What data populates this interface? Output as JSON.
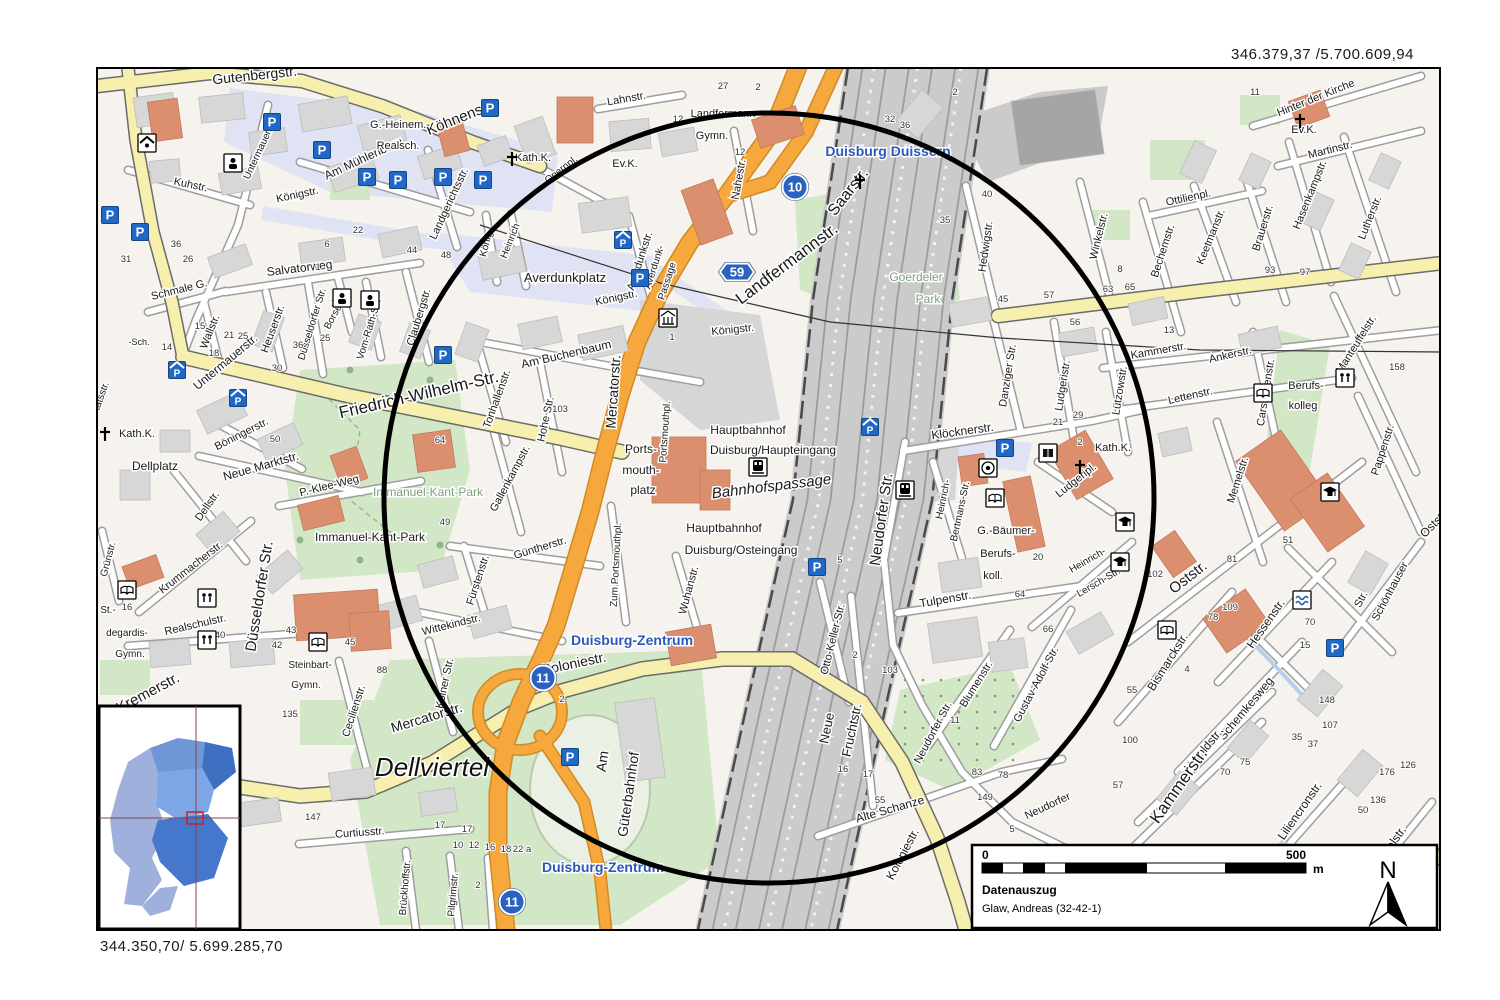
{
  "page": {
    "coordinates_top_right": "346.379,37 /5.700.609,94",
    "coordinates_bottom_left": "344.350,70/ 5.699.285,70"
  },
  "legend": {
    "scale_start": "0",
    "scale_end": "500",
    "scale_unit": "m",
    "title": "Datenauszug",
    "author": "Glaw, Andreas (32-42-1)",
    "north_label": "N"
  },
  "colors": {
    "street_fill": "#ffffff",
    "street_casing": "#9e9e9e",
    "main_road_yellow": "#f6efad",
    "motorway_orange": "#f6a83d",
    "park_green": "#d2e7c6",
    "pedestrian_blue": "#dfe3f4",
    "railway_gray": "#cbcbcb",
    "building_gray": "#d7d7d7",
    "building_salmon": "#db8f6f",
    "badge_blue": "#2a62c0",
    "place_label_blue": "#2c59b8",
    "park_label_green": "#7da07d",
    "circle_black": "#000000",
    "inset_blues": [
      "#9fb0dc",
      "#6f97d8",
      "#3f6fc0",
      "#7da6e6",
      "#4577cc"
    ]
  },
  "badges": [
    {
      "shape": "circle",
      "label": "10",
      "x": 795,
      "y": 187
    },
    {
      "shape": "circle",
      "label": "11",
      "x": 543,
      "y": 678
    },
    {
      "shape": "circle",
      "label": "11",
      "x": 512,
      "y": 902
    },
    {
      "shape": "motorway",
      "label": "59",
      "x": 737,
      "y": 272
    }
  ],
  "labels": [
    [
      "Gutenbergstr.",
      255,
      80,
      -6,
      14
    ],
    [
      "Köhnenstr.",
      462,
      122,
      -22,
      15
    ],
    [
      "Am Mühlenberg",
      365,
      162,
      -25,
      12
    ],
    [
      "G.-Heinem.-",
      400,
      128,
      0,
      11,
      "p"
    ],
    [
      "Realsch.",
      398,
      149,
      0,
      11,
      "p"
    ],
    [
      "Kath.K.",
      533,
      161,
      0,
      11,
      "p"
    ],
    [
      "Opernpl.",
      563,
      172,
      -38,
      10
    ],
    [
      "Kuhstr.",
      190,
      188,
      12,
      11
    ],
    [
      "Untermauerstr.",
      263,
      150,
      -65,
      10
    ],
    [
      "Untermauerstr.",
      228,
      365,
      -40,
      12
    ],
    [
      "Königstr.",
      298,
      198,
      -12,
      11
    ],
    [
      "Königstr.",
      617,
      301,
      -12,
      11
    ],
    [
      "Königstr.",
      733,
      333,
      -6,
      11
    ],
    [
      "Salvatorweg",
      300,
      272,
      -7,
      12
    ],
    [
      "Schmale G.",
      180,
      293,
      -14,
      11
    ],
    [
      "Wallstr.",
      213,
      333,
      -68,
      11
    ],
    [
      "Heuserstr.",
      276,
      330,
      -70,
      11
    ],
    [
      "Düsseldorfer Str.",
      315,
      325,
      -73,
      10
    ],
    [
      "Borsenstr.",
      340,
      310,
      -62,
      10
    ],
    [
      "Vom-Rath-Str.",
      372,
      330,
      -73,
      10
    ],
    [
      "Claubergstr.",
      422,
      318,
      -73,
      11
    ],
    [
      "Landgerichtsstr.",
      452,
      205,
      -65,
      11
    ],
    [
      "König",
      489,
      245,
      -75,
      10
    ],
    [
      "Heinrich",
      513,
      242,
      -68,
      10
    ],
    [
      "Averdunkplatz",
      565,
      282,
      0,
      13,
      "p"
    ],
    [
      "Am Buchenbaum",
      567,
      358,
      -13,
      12
    ],
    [
      "Tonhallenstr.",
      500,
      400,
      -70,
      11
    ],
    [
      "Hohe Str.",
      549,
      420,
      -78,
      11
    ],
    [
      "Friedrich-Wilhelm-Str.",
      420,
      400,
      -13,
      17
    ],
    [
      "Böningerstr.",
      243,
      437,
      -27,
      11
    ],
    [
      "Kath.K.",
      137,
      437,
      0,
      11,
      "p"
    ],
    [
      "Dellplatz",
      155,
      470,
      0,
      12,
      "p"
    ],
    [
      "Neue Marktstr.",
      262,
      470,
      -16,
      12
    ],
    [
      "P.-Klee-Weg",
      330,
      489,
      -14,
      11
    ],
    [
      "Immanuel-Kant-Park",
      428,
      496,
      0,
      12,
      "g"
    ],
    [
      "Immanuel-Kant-Park",
      370,
      541,
      0,
      12,
      "p"
    ],
    [
      "Dellstr.",
      210,
      508,
      -55,
      11
    ],
    [
      "Gallenkampstr.",
      513,
      480,
      -62,
      11
    ],
    [
      "Güntherstr.",
      541,
      551,
      -17,
      11
    ],
    [
      "Fürstenstr.",
      481,
      581,
      -72,
      11
    ],
    [
      "Wittekindstr.",
      452,
      628,
      -14,
      11
    ],
    [
      "Kölner Str.",
      448,
      684,
      -78,
      11
    ],
    [
      "Mercatorstr.",
      428,
      722,
      -17,
      14
    ],
    [
      "Mercatorstr.",
      618,
      392,
      -86,
      14
    ],
    [
      "Koloniestr.",
      575,
      668,
      -12,
      14
    ],
    [
      "Duisburg-Zentrum",
      632,
      645,
      0,
      14,
      "b"
    ],
    [
      "Duisburg-Zentrum",
      603,
      872,
      0,
      14,
      "b"
    ],
    [
      "Steinbart-",
      310,
      668,
      0,
      10,
      "p"
    ],
    [
      "Gymn.",
      306,
      688,
      0,
      10,
      "p"
    ],
    [
      "Cecilienstr.",
      357,
      712,
      -72,
      11
    ],
    [
      "Dellviertel",
      432,
      776,
      0,
      26,
      "i"
    ],
    [
      "Am",
      607,
      762,
      -82,
      14
    ],
    [
      "Güterbahnhof",
      633,
      795,
      -82,
      14
    ],
    [
      "Curtiusstr.",
      360,
      836,
      -4,
      11
    ],
    [
      "Krummacherstr.",
      193,
      570,
      -38,
      11
    ],
    [
      "Realschulstr.",
      196,
      628,
      -13,
      11
    ],
    [
      "Düsseldorfer Str.",
      264,
      597,
      -81,
      15
    ],
    [
      "St.-",
      108,
      613,
      0,
      10,
      "p"
    ],
    [
      "degardis-",
      127,
      636,
      0,
      10,
      "p"
    ],
    [
      "Gymn.",
      130,
      657,
      0,
      10,
      "p"
    ],
    [
      "Grünstr.",
      111,
      560,
      -75,
      10
    ],
    [
      "Kremerstr.",
      150,
      697,
      -28,
      15
    ],
    [
      "Brückhoffstr.",
      408,
      888,
      -85,
      10
    ],
    [
      "Pilgrimstr.",
      456,
      895,
      -85,
      10
    ],
    [
      "tätsstr.",
      104,
      397,
      -70,
      10
    ],
    [
      "-Sch.",
      139,
      345,
      0,
      9,
      "p"
    ],
    [
      "Lahnstr.",
      627,
      102,
      -10,
      11
    ],
    [
      "Landfermann",
      723,
      117,
      0,
      11,
      "p"
    ],
    [
      "Gymn.",
      712,
      139,
      0,
      11,
      "p"
    ],
    [
      "Ev.K.",
      625,
      167,
      0,
      11,
      "p"
    ],
    [
      "Nahestr.",
      742,
      180,
      -80,
      11
    ],
    [
      "Saarstr.",
      852,
      195,
      -52,
      16
    ],
    [
      "Duisburg Duissern",
      888,
      156,
      0,
      14,
      "b"
    ],
    [
      "Landfermannstr.",
      790,
      268,
      -37,
      17
    ],
    [
      "Averdunkstr.",
      643,
      262,
      -72,
      11
    ],
    [
      "Averdunk-",
      657,
      268,
      -72,
      10
    ],
    [
      "Passage",
      670,
      282,
      -72,
      10
    ],
    [
      "Goerdeler",
      916,
      281,
      0,
      12,
      "g"
    ],
    [
      "Park",
      928,
      303,
      0,
      12,
      "g"
    ],
    [
      "Hauptbahnhof",
      748,
      434,
      0,
      12,
      "p"
    ],
    [
      "Duisburg/Haupteingang",
      773,
      454,
      0,
      12,
      "p"
    ],
    [
      "Bahnhofspassage",
      772,
      491,
      -7,
      15,
      "it"
    ],
    [
      "Hauptbahnhof",
      724,
      532,
      0,
      12,
      "p"
    ],
    [
      "Duisburg/Osteingang",
      741,
      554,
      0,
      12,
      "p"
    ],
    [
      "Ports-",
      641,
      453,
      0,
      12,
      "p"
    ],
    [
      "mouth-",
      641,
      474,
      0,
      12,
      "p"
    ],
    [
      "platz",
      643,
      494,
      0,
      12,
      "p"
    ],
    [
      "Portsmouthpl.",
      668,
      432,
      -86,
      10
    ],
    [
      "Zum Portsmouthpl.",
      619,
      565,
      -87,
      10
    ],
    [
      "Wuhanstr.",
      692,
      591,
      -75,
      11
    ],
    [
      "Hedwigstr.",
      989,
      247,
      -82,
      11
    ],
    [
      "Winkelstr.",
      1102,
      237,
      -76,
      11
    ],
    [
      "Bechemstr.",
      1166,
      252,
      -72,
      11
    ],
    [
      "Ottilienpl.",
      1189,
      201,
      -12,
      11
    ],
    [
      "Hinter der Kirche",
      1317,
      101,
      -22,
      11
    ],
    [
      "Ev.K.",
      1304,
      133,
      0,
      11,
      "p"
    ],
    [
      "Martinstr.",
      1331,
      153,
      -14,
      11
    ],
    [
      "Hasenkampstr.",
      1313,
      196,
      -68,
      11
    ],
    [
      "Lutherstr.",
      1373,
      219,
      -68,
      11
    ],
    [
      "Keetmanstr.",
      1214,
      238,
      -68,
      11
    ],
    [
      "Brauerstr.",
      1266,
      229,
      -73,
      11
    ],
    [
      "Manteuffelstr.",
      1359,
      346,
      -58,
      11
    ],
    [
      "Kammerstr.",
      1159,
      354,
      -10,
      11
    ],
    [
      "Ankerstr.",
      1231,
      358,
      -13,
      11
    ],
    [
      "Lettenstr.",
      1191,
      399,
      -13,
      11
    ],
    [
      "Carstanjenstr.",
      1269,
      393,
      -81,
      11
    ],
    [
      "Berufs-",
      1306,
      389,
      0,
      11,
      "p"
    ],
    [
      "kolleg",
      1303,
      409,
      0,
      11,
      "p"
    ],
    [
      "Memelstr.",
      1241,
      481,
      -72,
      11
    ],
    [
      "Pappenstr.",
      1386,
      451,
      -72,
      11
    ],
    [
      "Danziger Str.",
      1011,
      376,
      -81,
      11
    ],
    [
      "Ludgeristr.",
      1066,
      386,
      -81,
      11
    ],
    [
      "Lützowstr.",
      1123,
      391,
      -81,
      11
    ],
    [
      "Klöcknerstr.",
      963,
      435,
      -8,
      12
    ],
    [
      "Kath.K.",
      1113,
      451,
      0,
      11,
      "p"
    ],
    [
      "Ludgeripl.",
      1078,
      483,
      -38,
      11
    ],
    [
      "Heinrich-",
      946,
      500,
      -78,
      10
    ],
    [
      "Bertmans-Str.",
      963,
      512,
      -78,
      10
    ],
    [
      "G.-Bäumer-",
      1006,
      534,
      0,
      11,
      "p"
    ],
    [
      "Berufs-",
      998,
      557,
      0,
      11,
      "p"
    ],
    [
      "koll.",
      993,
      579,
      0,
      11,
      "p"
    ],
    [
      "Neudorfer Str.",
      886,
      520,
      -82,
      15
    ],
    [
      "Neudorfer Str.",
      936,
      734,
      -62,
      11
    ],
    [
      "Heinrich-",
      1089,
      563,
      -30,
      10
    ],
    [
      "Lersch-Str.",
      1100,
      585,
      -30,
      10
    ],
    [
      "Oststr.",
      1191,
      581,
      -38,
      15
    ],
    [
      "Oststr.",
      1437,
      526,
      -45,
      12
    ],
    [
      "Hessenstr.",
      1269,
      626,
      -55,
      12
    ],
    [
      "Schönhauser",
      1393,
      593,
      -62,
      11
    ],
    [
      "Str.",
      1364,
      601,
      -62,
      11
    ],
    [
      "Bismarckstr.",
      1171,
      664,
      -58,
      12
    ],
    [
      "Schemkesweg",
      1249,
      711,
      -50,
      12
    ],
    [
      "Haroldstr.",
      1206,
      753,
      -50,
      12
    ],
    [
      "Kammerstr.",
      1183,
      789,
      -55,
      17
    ],
    [
      "Liliencronstr.",
      1303,
      813,
      -55,
      12
    ],
    [
      "Nettelstr.",
      1393,
      849,
      -55,
      12
    ],
    [
      "Otto-Keller-Str.",
      836,
      640,
      -76,
      11
    ],
    [
      "Neue",
      831,
      729,
      -78,
      13
    ],
    [
      "Fruchtstr.",
      856,
      731,
      -78,
      13
    ],
    [
      "Tulpenstr.",
      946,
      603,
      -10,
      12
    ],
    [
      "Blumenstr.",
      979,
      686,
      -58,
      11
    ],
    [
      "Gustav-Adolf-Str.",
      1039,
      686,
      -62,
      11
    ],
    [
      "Alte Schanze",
      891,
      813,
      -16,
      12
    ],
    [
      "Koloniestr.",
      906,
      856,
      -62,
      12
    ],
    [
      "Neudorfer",
      1049,
      809,
      -25,
      11
    ]
  ],
  "house_numbers": [
    [
      "36",
      176,
      247
    ],
    [
      "26",
      188,
      262
    ],
    [
      "31",
      126,
      262
    ],
    [
      "15",
      200,
      329
    ],
    [
      "21",
      229,
      338
    ],
    [
      "25",
      243,
      339
    ],
    [
      "14",
      167,
      350
    ],
    [
      "18",
      214,
      356
    ],
    [
      "30",
      277,
      371
    ],
    [
      "19",
      336,
      306
    ],
    [
      "22",
      358,
      233
    ],
    [
      "44",
      412,
      253
    ],
    [
      "48",
      446,
      258
    ],
    [
      "6",
      327,
      247
    ],
    [
      "1",
      318,
      270
    ],
    [
      "36",
      298,
      348
    ],
    [
      "25",
      325,
      341
    ],
    [
      "103",
      560,
      412
    ],
    [
      "50",
      275,
      442
    ],
    [
      "64",
      440,
      443
    ],
    [
      "49",
      445,
      525
    ],
    [
      "43",
      291,
      633
    ],
    [
      "40",
      220,
      638
    ],
    [
      "42",
      277,
      648
    ],
    [
      "45",
      350,
      645
    ],
    [
      "88",
      382,
      673
    ],
    [
      "135",
      290,
      717
    ],
    [
      "16",
      127,
      610
    ],
    [
      "147",
      313,
      820
    ],
    [
      "17",
      467,
      832
    ],
    [
      "2",
      562,
      702
    ],
    [
      "10",
      458,
      848
    ],
    [
      "12",
      474,
      848
    ],
    [
      "16",
      490,
      850
    ],
    [
      "18",
      506,
      852
    ],
    [
      "22 a",
      522,
      852
    ],
    [
      "17",
      440,
      828
    ],
    [
      "2",
      478,
      888
    ],
    [
      "2",
      758,
      90
    ],
    [
      "12",
      678,
      122
    ],
    [
      "12",
      740,
      155
    ],
    [
      "27",
      723,
      89
    ],
    [
      "32",
      890,
      122
    ],
    [
      "36",
      905,
      128
    ],
    [
      "2",
      955,
      95
    ],
    [
      "35",
      945,
      223
    ],
    [
      "40",
      987,
      197
    ],
    [
      "45",
      1003,
      302
    ],
    [
      "57",
      1049,
      298
    ],
    [
      "63",
      1108,
      292
    ],
    [
      "65",
      1130,
      290
    ],
    [
      "56",
      1075,
      325
    ],
    [
      "97",
      1305,
      275
    ],
    [
      "93",
      1270,
      273
    ],
    [
      "11",
      1255,
      95
    ],
    [
      "5",
      840,
      563
    ],
    [
      "2",
      855,
      658
    ],
    [
      "103",
      890,
      673
    ],
    [
      "11",
      955,
      723
    ],
    [
      "16",
      843,
      772
    ],
    [
      "17",
      868,
      777
    ],
    [
      "55",
      880,
      803
    ],
    [
      "83",
      977,
      775
    ],
    [
      "78",
      1003,
      778
    ],
    [
      "149",
      985,
      800
    ],
    [
      "5",
      1012,
      832
    ],
    [
      "64",
      1020,
      597
    ],
    [
      "66",
      1048,
      632
    ],
    [
      "20",
      1038,
      560
    ],
    [
      "102",
      1155,
      577
    ],
    [
      "81",
      1232,
      562
    ],
    [
      "51",
      1288,
      543
    ],
    [
      "109",
      1230,
      610
    ],
    [
      "78",
      1213,
      620
    ],
    [
      "70",
      1310,
      625
    ],
    [
      "15",
      1305,
      648
    ],
    [
      "148",
      1327,
      703
    ],
    [
      "107",
      1330,
      728
    ],
    [
      "35",
      1297,
      740
    ],
    [
      "37",
      1313,
      747
    ],
    [
      "75",
      1245,
      765
    ],
    [
      "70",
      1225,
      775
    ],
    [
      "55",
      1132,
      693
    ],
    [
      "4",
      1187,
      672
    ],
    [
      "100",
      1130,
      743
    ],
    [
      "176",
      1387,
      775
    ],
    [
      "126",
      1408,
      768
    ],
    [
      "136",
      1378,
      803
    ],
    [
      "50",
      1363,
      813
    ],
    [
      "57",
      1118,
      788
    ],
    [
      "158",
      1397,
      370
    ],
    [
      "13",
      1169,
      333
    ],
    [
      "2",
      1080,
      445
    ],
    [
      "29",
      1078,
      418
    ],
    [
      "21",
      1058,
      425
    ],
    [
      "8",
      1120,
      272
    ],
    [
      "1",
      672,
      340
    ]
  ],
  "icons": [
    [
      "parking",
      272,
      122
    ],
    [
      "parking",
      322,
      150
    ],
    [
      "parking",
      367,
      177
    ],
    [
      "parking",
      398,
      180
    ],
    [
      "parking",
      443,
      177
    ],
    [
      "parking",
      483,
      180
    ],
    [
      "parking",
      490,
      108
    ],
    [
      "parking",
      110,
      215
    ],
    [
      "parking",
      140,
      232
    ],
    [
      "parking",
      443,
      355
    ],
    [
      "parking",
      640,
      278
    ],
    [
      "parking",
      817,
      567
    ],
    [
      "parking",
      570,
      757
    ],
    [
      "parking",
      1005,
      448
    ],
    [
      "parking",
      1335,
      648
    ],
    [
      "parking-garage",
      238,
      398
    ],
    [
      "parking-garage",
      177,
      370
    ],
    [
      "parking-garage",
      623,
      240
    ],
    [
      "parking-garage",
      870,
      427
    ],
    [
      "train",
      758,
      467
    ],
    [
      "train",
      905,
      490
    ],
    [
      "church-cross",
      512,
      160
    ],
    [
      "church-cross",
      1080,
      468
    ],
    [
      "church-cross",
      1300,
      122
    ],
    [
      "church-cross",
      860,
      183
    ],
    [
      "church-cross",
      105,
      435
    ],
    [
      "book",
      127,
      590
    ],
    [
      "book",
      318,
      642
    ],
    [
      "book",
      1167,
      630
    ],
    [
      "book",
      995,
      498
    ],
    [
      "book",
      1263,
      393
    ],
    [
      "book-dark",
      1048,
      453
    ],
    [
      "grad-cap",
      1125,
      522
    ],
    [
      "grad-cap",
      1120,
      562
    ],
    [
      "grad-cap",
      1330,
      492
    ],
    [
      "soccer",
      988,
      468
    ],
    [
      "waves",
      1302,
      600
    ],
    [
      "museum",
      668,
      318
    ],
    [
      "home",
      147,
      143
    ],
    [
      "person",
      233,
      163
    ],
    [
      "person",
      342,
      298
    ],
    [
      "person",
      370,
      300
    ],
    [
      "figures",
      207,
      598
    ],
    [
      "figures",
      207,
      640
    ],
    [
      "figures",
      1345,
      378
    ]
  ]
}
